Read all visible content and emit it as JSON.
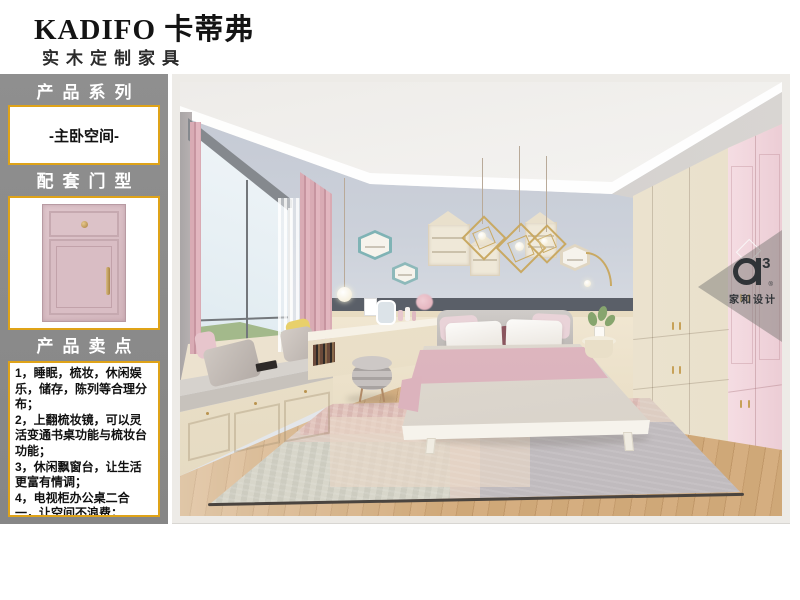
{
  "header": {
    "brand": "KADIFO 卡蒂弗",
    "subtitle": "实木定制家具"
  },
  "sidebar": {
    "series_title": "产品系列",
    "series_value": "-主卧空间-",
    "door_title": "配套门型",
    "points_title": "产品卖点",
    "points": [
      "1，睡眠，梳妆，休闲娱乐，储存，陈列等合理分布；",
      "2，上翻梳妆镜，可以灵活变通书桌功能与梳妆台功能；",
      "3，休闲飘窗台，让生活更富有情调；",
      "4，电视柜办公桌二合一，让空间不浪费；"
    ]
  },
  "watermark": {
    "logo_sup": "3",
    "logo_reg": "®",
    "name": "家和设计"
  },
  "colors": {
    "accent_gold": "#dfa318",
    "sidebar_gray": "#8b8b8b",
    "door_pink": "#d9bec4",
    "wall_blue_gray": "#ccd1da",
    "wardrobe_cream": "#efe7d4",
    "wardrobe_pink": "#f3d8de",
    "curtain_pink": "#d9abb4",
    "floor_wood": "#cfa878",
    "accent_band": "#5a5f68"
  }
}
